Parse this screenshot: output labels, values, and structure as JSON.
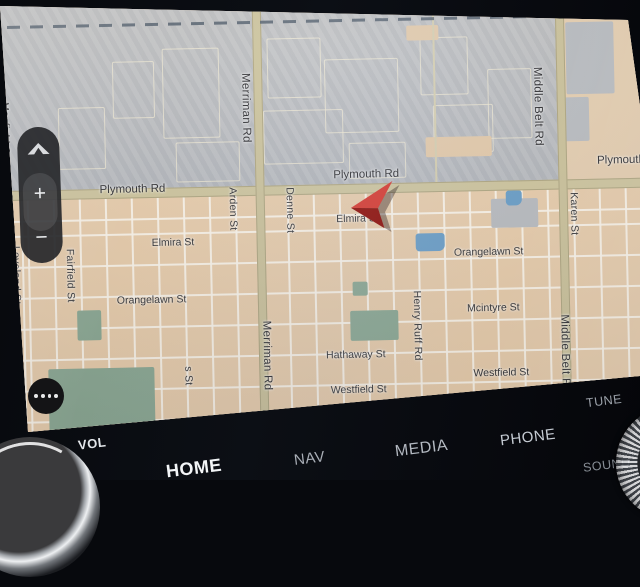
{
  "screen": {
    "map": {
      "street_labels_horizontal": [
        {
          "text": "Plymouth Rd",
          "x": 135,
          "y": 212,
          "major": true
        },
        {
          "text": "Plymouth Rd",
          "x": 369,
          "y": 202,
          "major": true
        },
        {
          "text": "Plymouth Rd",
          "x": 633,
          "y": 193,
          "major": true
        },
        {
          "text": "Elmira St",
          "x": 186,
          "y": 266
        },
        {
          "text": "Elmira St",
          "x": 371,
          "y": 246
        },
        {
          "text": "Orangelawn St",
          "x": 150,
          "y": 323
        },
        {
          "text": "Orangelawn St",
          "x": 488,
          "y": 282
        },
        {
          "text": "Mcintyre St",
          "x": 500,
          "y": 338
        },
        {
          "text": "Hathaway St",
          "x": 358,
          "y": 382
        },
        {
          "text": "Westfield St",
          "x": 362,
          "y": 417
        },
        {
          "text": "Westfield St",
          "x": 505,
          "y": 403
        }
      ],
      "street_labels_vertical": [
        {
          "text": "Mayfield St",
          "x": 36,
          "y": 128
        },
        {
          "text": "Loveland St",
          "x": 44,
          "y": 272
        },
        {
          "text": "Fairfield St",
          "x": 98,
          "y": 276
        },
        {
          "text": "Arden St",
          "x": 262,
          "y": 218
        },
        {
          "text": "Denne St",
          "x": 319,
          "y": 219
        },
        {
          "text": "Merriman Rd",
          "x": 277,
          "y": 104,
          "major": true
        },
        {
          "text": "Merriman Rd",
          "x": 293,
          "y": 352,
          "major": true
        },
        {
          "text": "Middle Belt Rd",
          "x": 569,
          "y": 104,
          "major": true
        },
        {
          "text": "Middle Belt Rd",
          "x": 591,
          "y": 352,
          "major": true
        },
        {
          "text": "Karen St",
          "x": 603,
          "y": 230
        },
        {
          "text": "Henry Ruff Rd",
          "x": 444,
          "y": 325
        },
        {
          "text": "s St",
          "x": 214,
          "y": 396
        },
        {
          "text": "olo",
          "x": 45,
          "y": 416
        }
      ],
      "vehicle_marker": {
        "icon": "red-arrow",
        "color": "#c8201a"
      }
    },
    "controls": {
      "pan_up_icon": "chevron-up",
      "zoom_in_label": "+",
      "zoom_out_label": "−",
      "more_icon": "ellipsis-dots"
    }
  },
  "hard_keys": {
    "vol": "VOL",
    "home": "HOME",
    "nav": "NAV",
    "media": "MEDIA",
    "phone": "PHONE",
    "tune": "TUNE",
    "sound": "SOUND"
  },
  "colors": {
    "residential": "#ecd1b0",
    "urban_area": "#bcbec2",
    "major_road": "#d2c9a2",
    "park": "#90ad98",
    "water": "#6fa3cc",
    "boundary_dash": "#56626f",
    "arrow_red": "#c8201a"
  }
}
